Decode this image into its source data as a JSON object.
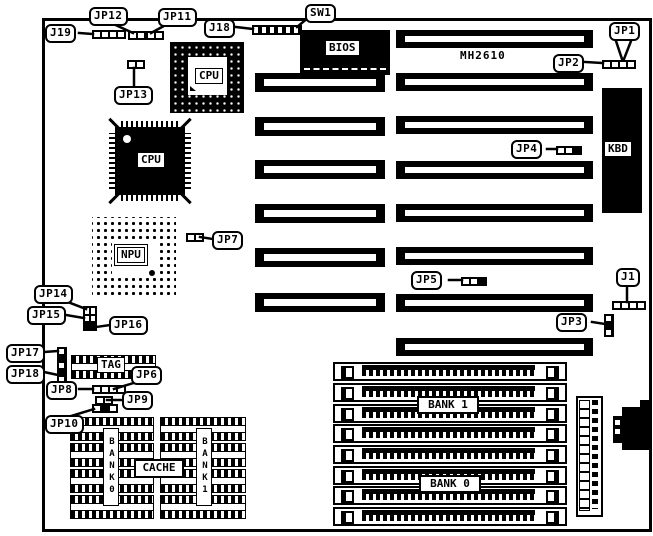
{
  "diagram": {
    "model_text": "MH2610",
    "palette": {
      "ink": "#000000",
      "paper": "#ffffff"
    },
    "labels": {
      "j19": "J19",
      "jp12": "JP12",
      "jp11": "JP11",
      "j18": "J18",
      "sw1": "SW1",
      "jp13": "JP13",
      "jp1": "JP1",
      "jp2": "JP2",
      "jp4": "JP4",
      "jp7": "JP7",
      "jp5": "JP5",
      "j1": "J1",
      "jp3": "JP3",
      "jp14": "JP14",
      "jp15": "JP15",
      "jp16": "JP16",
      "jp17": "JP17",
      "jp18": "JP18",
      "jp8": "JP8",
      "jp6": "JP6",
      "jp9": "JP9",
      "jp10": "JP10"
    },
    "chips": {
      "bios": "BIOS",
      "cpu_socket": "CPU",
      "cpu_qfp": "CPU",
      "npu": "NPU",
      "kbd": "KBD",
      "tag": "TAG"
    },
    "cache": {
      "label": "CACHE",
      "bank0_vertical": "BANK0",
      "bank1_vertical": "BANK1"
    },
    "memory": {
      "bank1": "BANK 1",
      "bank0": "BANK 0"
    }
  }
}
